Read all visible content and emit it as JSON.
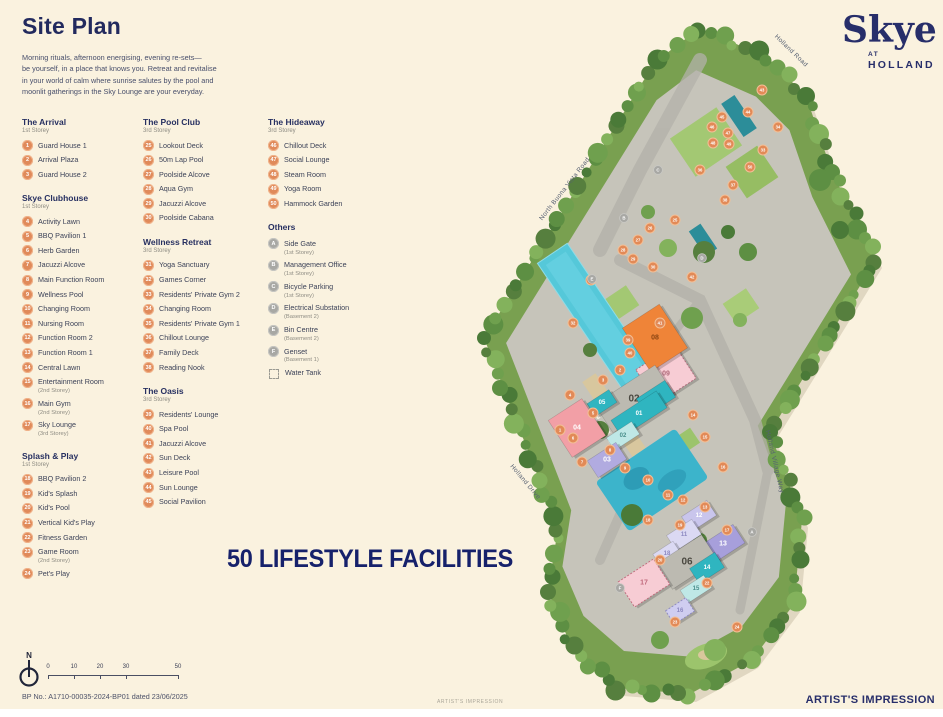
{
  "page": {
    "title": "Site Plan",
    "intro": "Morning rituals, afternoon energising, evening re-sets—\nbe yourself, in a place that knows you. Retreat and revitalise\nin your world of calm where sunrise salutes by the pool and\nmoonlit gatherings in the Sky Lounge are your everyday.",
    "banner": "50 LIFESTYLE FACILITIES",
    "bp_note": "BP No.: A1710-00035-2024-BP01 dated 23/06/2025",
    "artist_small": "ARTIST'S IMPRESSION",
    "artist_large": "ARTIST'S IMPRESSION"
  },
  "logo": {
    "name": "Skye",
    "at": "AT",
    "holland": "HOLLAND"
  },
  "colors": {
    "accent_navy": "#16216b",
    "badge_orange": "#e08a5a",
    "badge_gray": "#a8a8a4",
    "background": "#faf2df"
  },
  "legend": {
    "groups": [
      {
        "title": "The Arrival",
        "storey": "1st Storey",
        "items": [
          {
            "num": "1",
            "label": "Guard House 1"
          },
          {
            "num": "2",
            "label": "Arrival Plaza"
          },
          {
            "num": "3",
            "label": "Guard House 2"
          }
        ]
      },
      {
        "title": "Skye Clubhouse",
        "storey": "1st Storey",
        "items": [
          {
            "num": "4",
            "label": "Activity Lawn"
          },
          {
            "num": "5",
            "label": "BBQ Pavilion 1"
          },
          {
            "num": "6",
            "label": "Herb Garden"
          },
          {
            "num": "7",
            "label": "Jacuzzi Alcove"
          },
          {
            "num": "8",
            "label": "Main Function Room"
          },
          {
            "num": "9",
            "label": "Wellness Pool"
          },
          {
            "num": "10",
            "label": "Changing Room"
          },
          {
            "num": "11",
            "label": "Nursing Room"
          },
          {
            "num": "12",
            "label": "Function Room 2"
          },
          {
            "num": "13",
            "label": "Function Room 1"
          },
          {
            "num": "14",
            "label": "Central Lawn"
          },
          {
            "num": "15",
            "label": "Entertainment Room",
            "note": "(2nd Storey)"
          },
          {
            "num": "16",
            "label": "Main Gym",
            "note": "(2nd Storey)"
          },
          {
            "num": "17",
            "label": "Sky Lounge",
            "note": "(3rd Storey)"
          }
        ]
      },
      {
        "title": "Splash & Play",
        "storey": "1st Storey",
        "items": [
          {
            "num": "18",
            "label": "BBQ Pavilion 2"
          },
          {
            "num": "19",
            "label": "Kid's Splash"
          },
          {
            "num": "20",
            "label": "Kid's Pool"
          },
          {
            "num": "21",
            "label": "Vertical Kid's Play"
          },
          {
            "num": "22",
            "label": "Fitness Garden"
          },
          {
            "num": "23",
            "label": "Game Room",
            "note": "(2nd Storey)"
          },
          {
            "num": "24",
            "label": "Pet's Play"
          }
        ]
      },
      {
        "title": "The Pool Club",
        "storey": "3rd Storey",
        "items": [
          {
            "num": "25",
            "label": "Lookout Deck"
          },
          {
            "num": "26",
            "label": "50m Lap Pool"
          },
          {
            "num": "27",
            "label": "Poolside Alcove"
          },
          {
            "num": "28",
            "label": "Aqua Gym"
          },
          {
            "num": "29",
            "label": "Jacuzzi Alcove"
          },
          {
            "num": "30",
            "label": "Poolside Cabana"
          }
        ]
      },
      {
        "title": "Wellness Retreat",
        "storey": "3rd Storey",
        "items": [
          {
            "num": "31",
            "label": "Yoga Sanctuary"
          },
          {
            "num": "32",
            "label": "Games Corner"
          },
          {
            "num": "33",
            "label": "Residents' Private Gym 2"
          },
          {
            "num": "34",
            "label": "Changing Room"
          },
          {
            "num": "35",
            "label": "Residents' Private Gym 1"
          },
          {
            "num": "36",
            "label": "Chillout Lounge"
          },
          {
            "num": "37",
            "label": "Family Deck"
          },
          {
            "num": "38",
            "label": "Reading Nook"
          }
        ]
      },
      {
        "title": "The Oasis",
        "storey": "3rd Storey",
        "items": [
          {
            "num": "39",
            "label": "Residents' Lounge"
          },
          {
            "num": "40",
            "label": "Spa Pool"
          },
          {
            "num": "41",
            "label": "Jacuzzi Alcove"
          },
          {
            "num": "42",
            "label": "Sun Deck"
          },
          {
            "num": "43",
            "label": "Leisure Pool"
          },
          {
            "num": "44",
            "label": "Sun Lounge"
          },
          {
            "num": "45",
            "label": "Social Pavilion"
          }
        ]
      },
      {
        "title": "The Hideaway",
        "storey": "3rd Storey",
        "items": [
          {
            "num": "46",
            "label": "Chillout Deck"
          },
          {
            "num": "47",
            "label": "Social Lounge"
          },
          {
            "num": "48",
            "label": "Steam Room"
          },
          {
            "num": "49",
            "label": "Yoga Room"
          },
          {
            "num": "50",
            "label": "Hammock Garden"
          }
        ]
      }
    ],
    "others": {
      "title": "Others",
      "items": [
        {
          "letter": "A",
          "label": "Side Gate",
          "note": "(1st Storey)"
        },
        {
          "letter": "B",
          "label": "Management Office",
          "note": "(1st Storey)"
        },
        {
          "letter": "C",
          "label": "Bicycle Parking",
          "note": "(1st Storey)"
        },
        {
          "letter": "D",
          "label": "Electrical Substation",
          "note": "(Basement 2)"
        },
        {
          "letter": "E",
          "label": "Bin Centre",
          "note": "(Basement 2)"
        },
        {
          "letter": "F",
          "label": "Genset",
          "note": "(Basement 1)"
        }
      ],
      "water_tank": "Water Tank"
    }
  },
  "scalebar": {
    "north": "N",
    "ticks": [
      "0",
      "10",
      "20",
      "30",
      "50"
    ]
  },
  "map": {
    "road_labels": [
      {
        "text": "Holland Road",
        "x": 790,
        "y": 52,
        "rot": 44
      },
      {
        "text": "North Buona Vista Road",
        "x": 566,
        "y": 190,
        "rot": -52
      },
      {
        "text": "Holland Village Way",
        "x": 773,
        "y": 462,
        "rot": 77
      },
      {
        "text": "Holland Drive",
        "x": 524,
        "y": 483,
        "rot": 50
      }
    ],
    "blocks": [
      {
        "label": "09",
        "x": 666,
        "y": 374,
        "w": 46,
        "h": 40,
        "fill": "#f7ccd4",
        "tc": "#b06a7a",
        "fs": 7,
        "dash": true
      },
      {
        "label": "08",
        "x": 655,
        "y": 338,
        "w": 44,
        "h": 52,
        "fill": "#ef8438",
        "tc": "#8a4412",
        "fs": 7
      },
      {
        "label": "02",
        "x": 634,
        "y": 399,
        "w": 72,
        "h": 34,
        "fill": "#bcbab1",
        "tc": "#4a4840",
        "fs": 10
      },
      {
        "label": "10",
        "x": 656,
        "y": 398,
        "w": 34,
        "h": 20,
        "fill": "#2fb5c0",
        "tc": "#ffffff",
        "fs": 6
      },
      {
        "label": "05",
        "x": 602,
        "y": 403,
        "w": 26,
        "h": 15,
        "fill": "#2fb5c0",
        "tc": "#ffffff",
        "fs": 6
      },
      {
        "label": "01",
        "x": 639,
        "y": 414,
        "w": 54,
        "h": 20,
        "fill": "#2fb5c0",
        "tc": "#ffffff",
        "fs": 6
      },
      {
        "label": "04",
        "x": 577,
        "y": 428,
        "w": 40,
        "h": 44,
        "fill": "#f29fa6",
        "tc": "#ffffff",
        "fs": 7
      },
      {
        "label": "02",
        "x": 623,
        "y": 436,
        "w": 30,
        "h": 15,
        "fill": "#bfe8e6",
        "tc": "#4a8f8c",
        "fs": 6
      },
      {
        "label": "03",
        "x": 607,
        "y": 460,
        "w": 34,
        "h": 20,
        "fill": "#b1abe0",
        "tc": "#ffffff",
        "fs": 7
      },
      {
        "label": "12",
        "x": 699,
        "y": 516,
        "w": 30,
        "h": 18,
        "fill": "#c9c5ec",
        "tc": "#ffffff",
        "fs": 6
      },
      {
        "label": "11",
        "x": 684,
        "y": 535,
        "w": 30,
        "h": 18,
        "fill": "#dbd9f3",
        "tc": "#8c88c0",
        "fs": 6
      },
      {
        "label": "13",
        "x": 723,
        "y": 544,
        "w": 38,
        "h": 22,
        "fill": "#a79fdb",
        "tc": "#ffffff",
        "fs": 7
      },
      {
        "label": "18",
        "x": 667,
        "y": 554,
        "w": 24,
        "h": 15,
        "fill": "#dbd9f3",
        "tc": "#8c88c0",
        "fs": 6
      },
      {
        "label": "06",
        "x": 687,
        "y": 562,
        "w": 54,
        "h": 30,
        "fill": "#bcbab1",
        "tc": "#4a4840",
        "fs": 10
      },
      {
        "label": "14",
        "x": 707,
        "y": 568,
        "w": 30,
        "h": 18,
        "fill": "#2fb5c0",
        "tc": "#ffffff",
        "fs": 6
      },
      {
        "label": "15",
        "x": 696,
        "y": 589,
        "w": 28,
        "h": 15,
        "fill": "#bfe8e6",
        "tc": "#4a8f8c",
        "fs": 6
      },
      {
        "label": "17",
        "x": 644,
        "y": 583,
        "w": 42,
        "h": 30,
        "fill": "#f7ccd4",
        "tc": "#c06a7c",
        "fs": 7,
        "dash": true
      },
      {
        "label": "16",
        "x": 680,
        "y": 611,
        "w": 24,
        "h": 16,
        "fill": "#cfcdf0",
        "tc": "#8c88c0",
        "fs": 6,
        "dash": true
      }
    ],
    "dots": [
      {
        "n": "43",
        "x": 762,
        "y": 90
      },
      {
        "n": "44",
        "x": 748,
        "y": 112
      },
      {
        "n": "45",
        "x": 722,
        "y": 117
      },
      {
        "n": "46",
        "x": 712,
        "y": 127
      },
      {
        "n": "47",
        "x": 728,
        "y": 133
      },
      {
        "n": "48",
        "x": 713,
        "y": 143
      },
      {
        "n": "49",
        "x": 729,
        "y": 144
      },
      {
        "n": "50",
        "x": 750,
        "y": 167
      },
      {
        "n": "34",
        "x": 778,
        "y": 127
      },
      {
        "n": "33",
        "x": 763,
        "y": 150
      },
      {
        "n": "36",
        "x": 700,
        "y": 170
      },
      {
        "n": "37",
        "x": 733,
        "y": 185
      },
      {
        "n": "38",
        "x": 725,
        "y": 200
      },
      {
        "n": "25",
        "x": 675,
        "y": 220
      },
      {
        "n": "26",
        "x": 650,
        "y": 228
      },
      {
        "n": "27",
        "x": 638,
        "y": 240
      },
      {
        "n": "28",
        "x": 623,
        "y": 250
      },
      {
        "n": "29",
        "x": 633,
        "y": 259
      },
      {
        "n": "30",
        "x": 653,
        "y": 267
      },
      {
        "n": "42",
        "x": 692,
        "y": 277
      },
      {
        "n": "31",
        "x": 591,
        "y": 280
      },
      {
        "n": "32",
        "x": 573,
        "y": 323
      },
      {
        "n": "41",
        "x": 660,
        "y": 323
      },
      {
        "n": "39",
        "x": 628,
        "y": 340
      },
      {
        "n": "40",
        "x": 630,
        "y": 353
      },
      {
        "n": "2",
        "x": 620,
        "y": 370
      },
      {
        "n": "3",
        "x": 603,
        "y": 380
      },
      {
        "n": "1",
        "x": 560,
        "y": 430
      },
      {
        "n": "4",
        "x": 570,
        "y": 395
      },
      {
        "n": "5",
        "x": 593,
        "y": 413
      },
      {
        "n": "6",
        "x": 573,
        "y": 438
      },
      {
        "n": "7",
        "x": 582,
        "y": 462
      },
      {
        "n": "8",
        "x": 610,
        "y": 450
      },
      {
        "n": "9",
        "x": 625,
        "y": 468
      },
      {
        "n": "10",
        "x": 648,
        "y": 480
      },
      {
        "n": "11",
        "x": 668,
        "y": 495
      },
      {
        "n": "12",
        "x": 683,
        "y": 500
      },
      {
        "n": "13",
        "x": 705,
        "y": 507
      },
      {
        "n": "14",
        "x": 693,
        "y": 415
      },
      {
        "n": "15",
        "x": 705,
        "y": 437
      },
      {
        "n": "16",
        "x": 723,
        "y": 467
      },
      {
        "n": "17",
        "x": 727,
        "y": 530
      },
      {
        "n": "18",
        "x": 648,
        "y": 520
      },
      {
        "n": "19",
        "x": 680,
        "y": 525
      },
      {
        "n": "20",
        "x": 660,
        "y": 560
      },
      {
        "n": "22",
        "x": 707,
        "y": 583
      },
      {
        "n": "23",
        "x": 675,
        "y": 622
      },
      {
        "n": "24",
        "x": 737,
        "y": 627
      }
    ],
    "letters": [
      {
        "l": "A",
        "x": 752,
        "y": 532
      },
      {
        "l": "B",
        "x": 624,
        "y": 218
      },
      {
        "l": "C",
        "x": 658,
        "y": 170
      },
      {
        "l": "D",
        "x": 702,
        "y": 258
      },
      {
        "l": "E",
        "x": 592,
        "y": 279
      },
      {
        "l": "F",
        "x": 620,
        "y": 588
      }
    ]
  }
}
